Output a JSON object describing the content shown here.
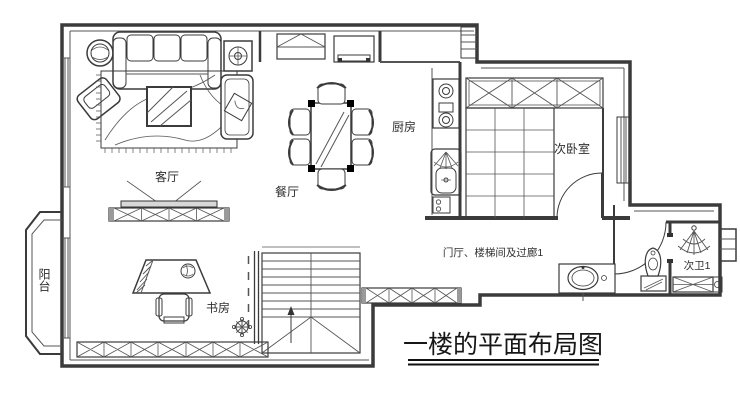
{
  "floor_plan": {
    "title": "一楼的平面布局图",
    "rooms": {
      "living_room": "客厅",
      "dining_room": "餐厅",
      "kitchen": "厨房",
      "secondary_bedroom": "次卧室",
      "balcony": "阳台",
      "study": "书房",
      "hallway": "门厅、楼梯间及过廊1",
      "secondary_bathroom": "次卫1"
    }
  }
}
